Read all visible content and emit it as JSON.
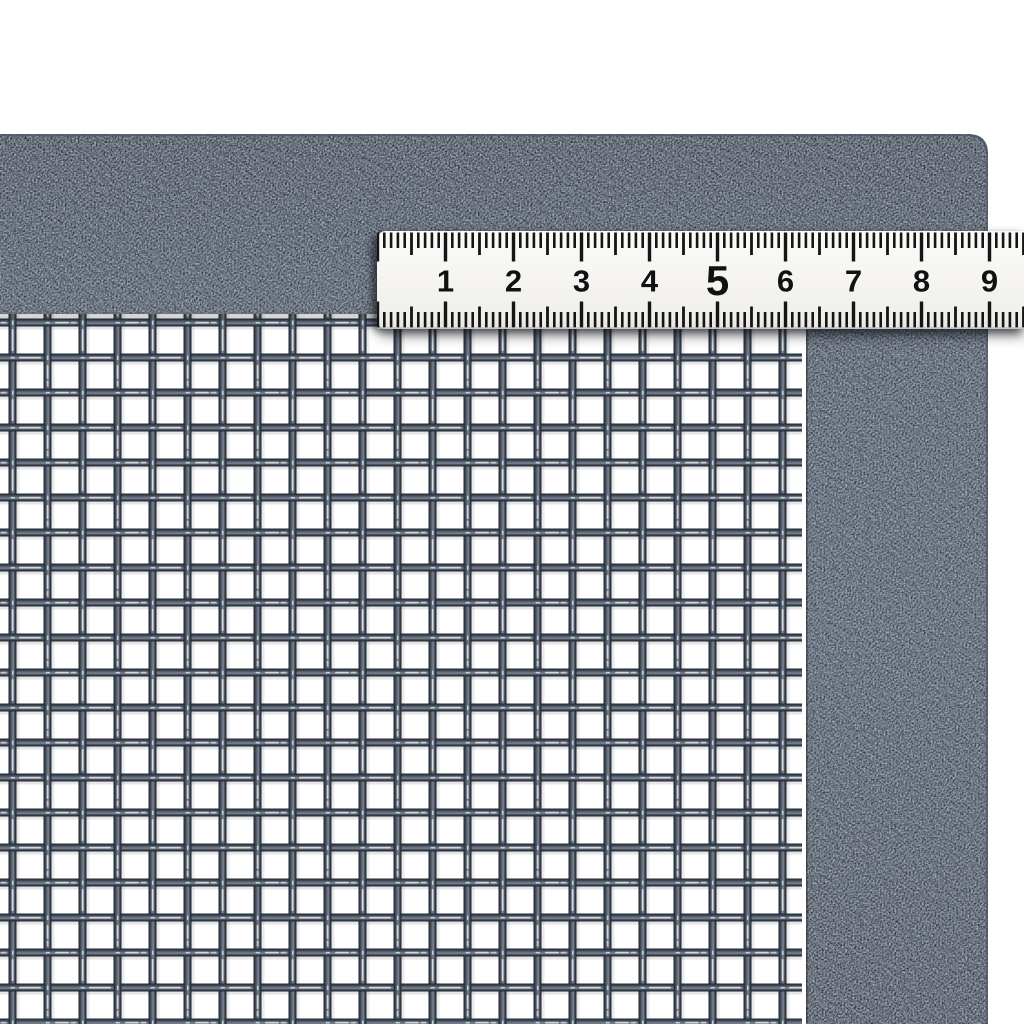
{
  "photo": {
    "ruler": {
      "numbers": [
        "1",
        "2",
        "3",
        "4",
        "5",
        "6",
        "7",
        "8",
        "9"
      ],
      "emphasized_number": "5"
    },
    "colors": {
      "background": "#ffffff",
      "frame_base": "#2f3641",
      "frame_speckle": "#6e7988",
      "mesh_wire": "#46505d",
      "mesh_opening": "#ffffff",
      "ruler_face": "#f6f5f1",
      "ruler_tick": "#141517",
      "ruler_number": "#101113"
    }
  }
}
